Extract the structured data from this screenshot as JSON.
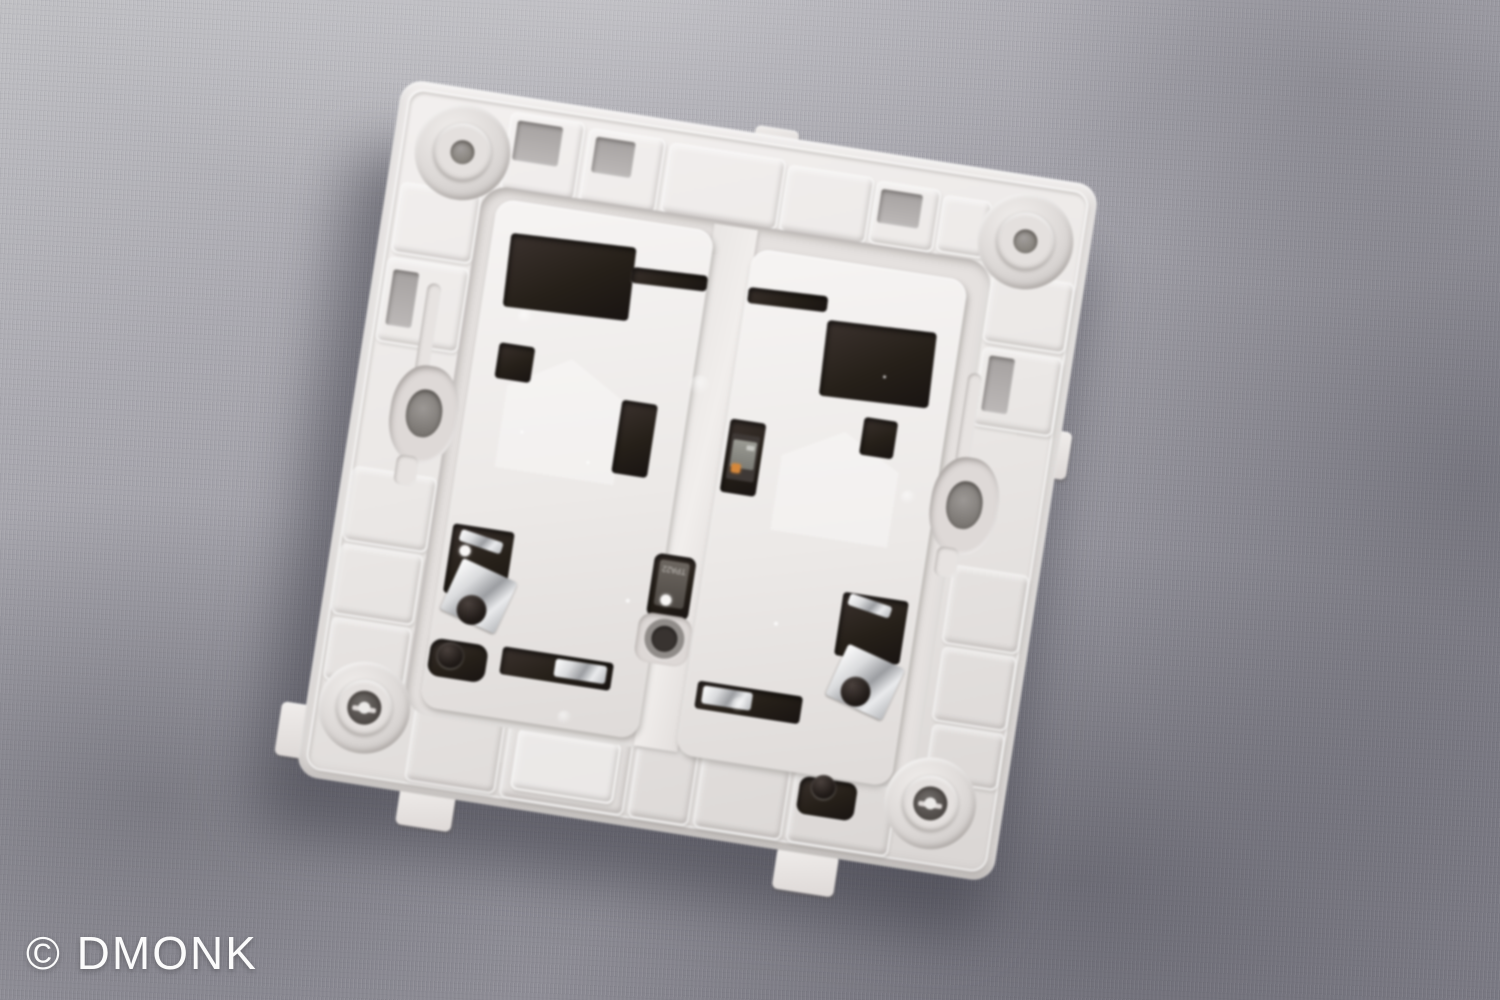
{
  "scene": {
    "description": "Macro photograph of the back side of a white plastic two-gang wall light-switch mounting plate, tilted, lying on gray woven fabric",
    "watermark": "© DMONK",
    "component_marking": "TPA22"
  },
  "colors": {
    "fabric-light": "#c1c1c5",
    "fabric-mid": "#9a99a1",
    "fabric-dark": "#7f7e88",
    "plastic": "#ebe8e6",
    "plastic-bright": "#f6f4f3",
    "plastic-shade": "#c6c2c0",
    "opening": "#262019",
    "opening-deep": "#191412",
    "metal-bright": "#f2f3f4",
    "metal-dark": "#8f9094",
    "led-orange": "#d5873a",
    "hole-gray": "#a4a09e",
    "shadow": "#32323c",
    "watermark": "#ffffff"
  }
}
